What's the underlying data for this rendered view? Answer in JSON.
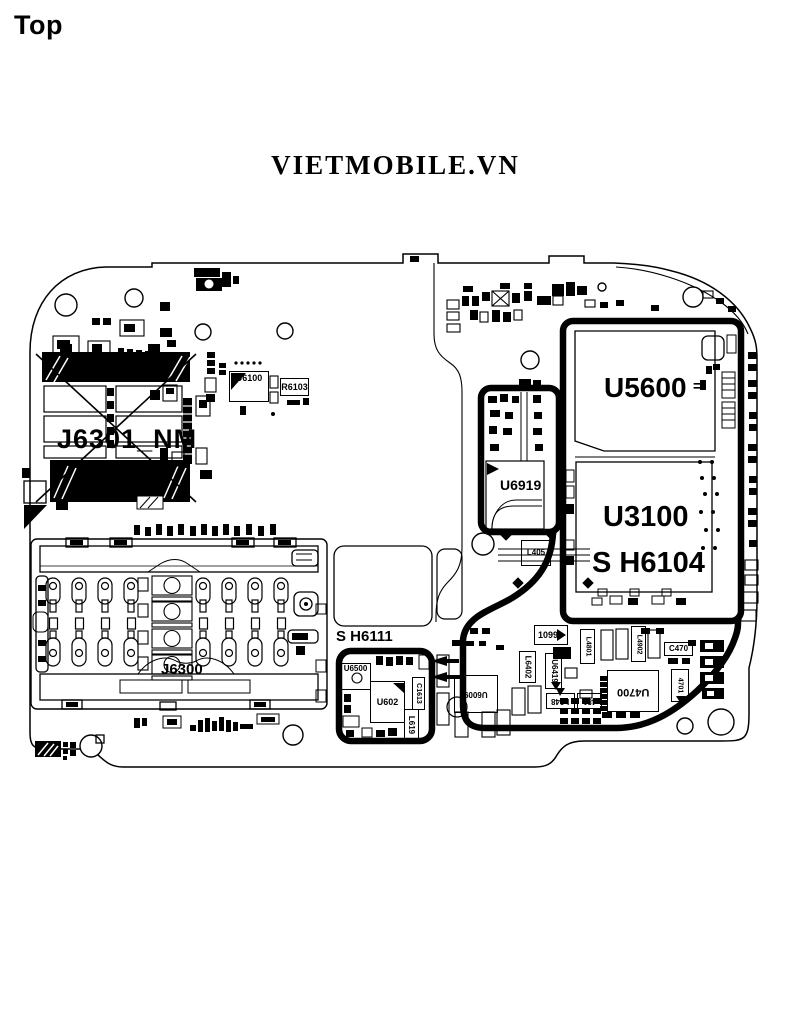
{
  "page": {
    "top_label": "Top",
    "title": "VIETMOBILE.VN"
  },
  "board": {
    "large_labels": {
      "j6301": "J6301_NM",
      "u5600": "U5600",
      "u5600_eq": "=",
      "u6919": "U6919",
      "u3100": "U3100",
      "sh6104": "S H6104",
      "j6300": "J6300",
      "sh6111": "S H6111"
    },
    "small_labels": {
      "u6100": "U6100",
      "r6103": "R6103",
      "u6500": "U6500",
      "u6602": "U602",
      "c1613": "C1613",
      "l619": "L619",
      "u6009": "U6009",
      "l6402": "L6402",
      "u6419": "U6419",
      "l1099": "1099",
      "u4700": "U4700",
      "c470": "C470",
      "l4801": "L4801",
      "l4902": "L4902",
      "l648": "L648",
      "l481": "481",
      "l4701": "4701",
      "l405": "L405"
    },
    "colors": {
      "ink": "#000000",
      "background": "#ffffff"
    }
  }
}
